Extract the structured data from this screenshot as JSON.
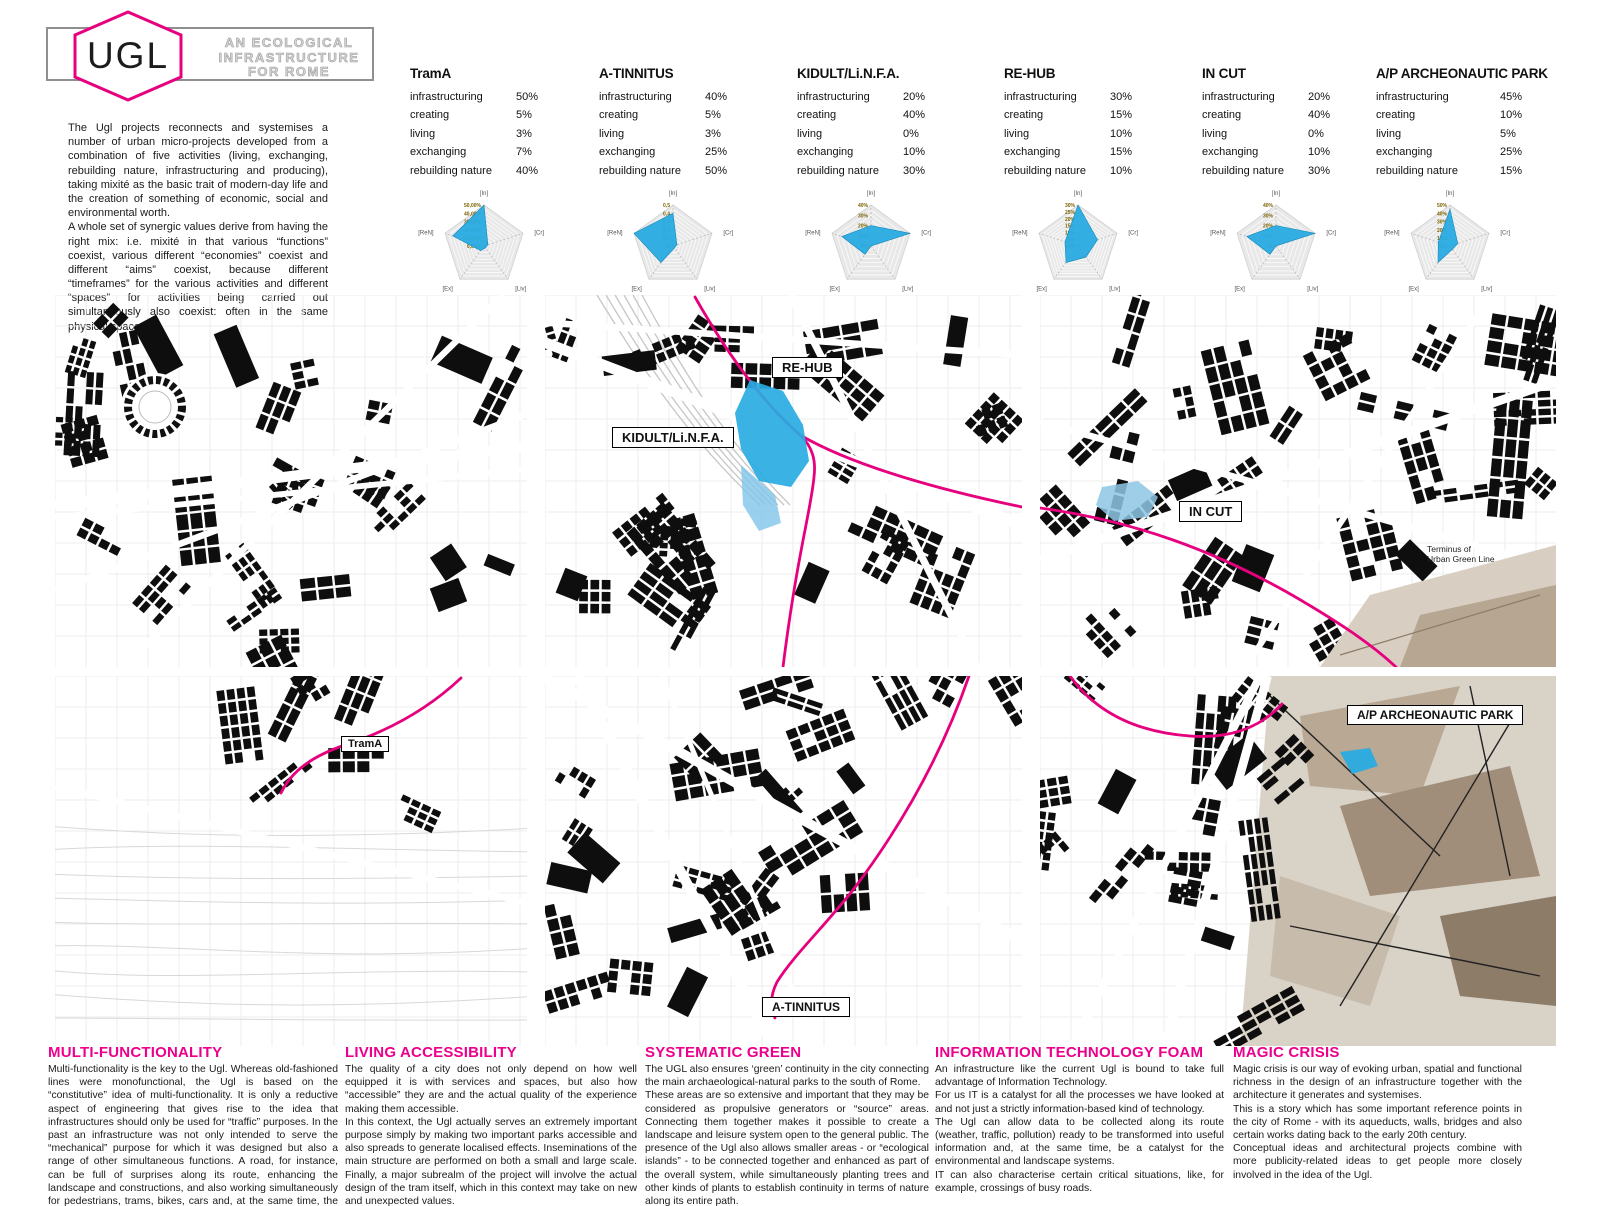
{
  "colors": {
    "magenta": "#e6007e",
    "heading_pink": "#ec008c",
    "radar_blue": "#29abe2",
    "light_blue": "#8ec6e4",
    "tan": "#c9bcab"
  },
  "header": {
    "logo_text": "UGL",
    "subtitle": "AN ECOLOGICAL\nINFRASTRUCTURE\nFOR ROME",
    "intro": "The Ugl projects reconnects and systemises a number of urban micro-projects developed from a combination of five activities (living, exchanging, rebuilding nature, infrastructuring and producing), taking mixité as the basic trait of modern-day life and the creation of something of economic, social and environmental worth.\nA whole set of synergic values derive from having the right mix: i.e. mixité in that various “functions” coexist, various different “economies” coexist and different “aims” coexist, because different “timeframes” for the various activities and different “spaces” for activities being carried out simultaneously also coexist: often in the same physical space."
  },
  "stat_labels": [
    "infrastructuring",
    "creating",
    "living",
    "exchanging",
    "rebuilding nature"
  ],
  "projects": [
    {
      "name": "TramA",
      "stats": [
        "50%",
        "5%",
        "3%",
        "7%",
        "40%"
      ]
    },
    {
      "name": "A-TINNITUS",
      "stats": [
        "40%",
        "5%",
        "3%",
        "25%",
        "50%"
      ]
    },
    {
      "name": "KIDULT/Li.N.F.A.",
      "stats": [
        "20%",
        "40%",
        "0%",
        "10%",
        "30%"
      ]
    },
    {
      "name": "RE-HUB",
      "stats": [
        "30%",
        "15%",
        "10%",
        "15%",
        "10%"
      ]
    },
    {
      "name": "IN CUT",
      "stats": [
        "20%",
        "40%",
        "0%",
        "10%",
        "30%"
      ]
    },
    {
      "name": "A/P ARCHEONAUTIC PARK",
      "stats": [
        "45%",
        "10%",
        "5%",
        "25%",
        "15%"
      ]
    }
  ],
  "chart_data": [
    {
      "type": "radar",
      "title": "TramA",
      "axes": [
        "[In]",
        "[Cr]",
        "[Liv]",
        "[Ex]",
        "[ReN]"
      ],
      "axis_meaning": [
        "infrastructuring",
        "creating",
        "living",
        "exchanging",
        "rebuilding nature"
      ],
      "values": [
        50,
        5,
        3,
        7,
        40
      ],
      "scale_max": 50,
      "tick_labels": [
        "50,00%",
        "40,00%",
        "30,00%",
        "20,00%",
        "10,00%",
        "0,00%"
      ]
    },
    {
      "type": "radar",
      "title": "A-TINNITUS",
      "axes": [
        "[In]",
        "[Cr]",
        "[Liv]",
        "[Ex]",
        "[ReN]"
      ],
      "axis_meaning": [
        "infrastructuring",
        "creating",
        "living",
        "exchanging",
        "rebuilding nature"
      ],
      "values": [
        40,
        5,
        3,
        25,
        50
      ],
      "scale_max": 50,
      "tick_labels": [
        "0,5",
        "0,4",
        "0,3",
        "0,2",
        "0,1",
        "0"
      ]
    },
    {
      "type": "radar",
      "title": "KIDULT/Li.N.F.A.",
      "axes": [
        "[In]",
        "[Cr]",
        "[Liv]",
        "[Ex]",
        "[ReN]"
      ],
      "axis_meaning": [
        "infrastructuring",
        "creating",
        "living",
        "exchanging",
        "rebuilding nature"
      ],
      "values": [
        20,
        40,
        0,
        10,
        30
      ],
      "scale_max": 40,
      "tick_labels": [
        "40%",
        "30%",
        "20%",
        "10%",
        "0%"
      ]
    },
    {
      "type": "radar",
      "title": "RE-HUB",
      "axes": [
        "[In]",
        "[Cr]",
        "[Liv]",
        "[Ex]",
        "[ReN]"
      ],
      "axis_meaning": [
        "infrastructuring",
        "creating",
        "living",
        "exchanging",
        "rebuilding nature"
      ],
      "values": [
        30,
        15,
        10,
        15,
        10
      ],
      "scale_max": 30,
      "tick_labels": [
        "30%",
        "25%",
        "20%",
        "15%",
        "10%",
        "5%",
        "0%"
      ]
    },
    {
      "type": "radar",
      "title": "IN CUT",
      "axes": [
        "[In]",
        "[Cr]",
        "[Liv]",
        "[Ex]",
        "[ReN]"
      ],
      "axis_meaning": [
        "infrastructuring",
        "creating",
        "living",
        "exchanging",
        "rebuilding nature"
      ],
      "values": [
        20,
        40,
        0,
        10,
        30
      ],
      "scale_max": 40,
      "tick_labels": [
        "40%",
        "30%",
        "20%",
        "10%",
        "0%"
      ]
    },
    {
      "type": "radar",
      "title": "A/P ARCHEONAUTIC PARK",
      "axes": [
        "[In]",
        "[Cr]",
        "[Liv]",
        "[Ex]",
        "[ReN]"
      ],
      "axis_meaning": [
        "infrastructuring",
        "creating",
        "living",
        "exchanging",
        "rebuilding nature"
      ],
      "values": [
        45,
        10,
        5,
        25,
        15
      ],
      "scale_max": 50,
      "tick_labels": [
        "50%",
        "40%",
        "30%",
        "20%",
        "10%",
        "0%"
      ]
    }
  ],
  "maps": {
    "labels": {
      "re_hub": "RE-HUB",
      "kidult": "KIDULT/Li.N.F.A.",
      "in_cut": "IN CUT",
      "trama": "TramA",
      "a_tinnitus": "A-TINNITUS",
      "ap_park": "A/P ARCHEONAUTIC PARK",
      "terminus_note": "Terminus of\nUrban Green Line"
    }
  },
  "sections": [
    {
      "heading": "MULTI-FUNCTIONALITY",
      "body": "Multi-functionality is the key to the Ugl. Whereas old-fashioned lines were monofunctional, the Ugl is based on the “constitutive” idea of multi-functionality. It is only a reductive aspect of engineering that gives rise to the idea that infrastructures should only be used for “traffic”  purposes. In the past an infrastructure was not only intended to serve the “mechanical” purpose for which it was designed but also a range of other simultaneous functions. A road, for instance, can be full of surprises along its route, enhancing the landscape and constructions, and also working simultaneously for pedestrians, trams, bikes, cars and, at the same time, the human spirit."
    },
    {
      "heading": "LIVING ACCESSIBILITY",
      "body": "The quality of a city does not only depend on how well equipped it is with services and spaces, but also how “accessible” they are and the actual quality of the experience making them accessible.\nIn this context, the Ugl actually serves an extremely important purpose simply by making two important parks accessible and also spreads to generate localised effects. Inseminations of the main structure are performed on both a small and large scale. Finally, a major subrealm of the project will involve the actual design of the tram itself, which in this context may take on new and unexpected values."
    },
    {
      "heading": "SYSTEMATIC GREEN",
      "body": "The UGL also ensures ‘green’ continuity in the city connecting the main archaeological-natural parks to the south of Rome.\nThese areas are so extensive and important that they may be considered as propulsive generators or “source” areas. Connecting them together makes it possible to create a landscape and leisure system open to the general public. The presence of the Ugl also allows smaller areas - or “ecological islands” - to be connected together and enhanced as part of the overall system, while simultaneously planting trees and other kinds of plants to establish continuity in terms of nature along its entire path."
    },
    {
      "heading": "INFORMATION TECHNOLOGY FOAM",
      "body": "An infrastructure like the current Ugl is bound to take full advantage of Information Technology.\nFor us IT is a catalyst for all the processes we have looked at and not just a strictly information-based kind of technology.\nThe Ugl can allow data to be collected along its route (weather, traffic, pollution) ready to be transformed into useful information and, at the same time, be a catalyst for the environmental and landscape systems.\nIT can also characterise certain critical situations, like, for example, crossings of busy roads."
    },
    {
      "heading": "MAGIC CRISIS",
      "body": "Magic crisis is our way of evoking urban, spatial and functional richness in the design of an infrastructure together with the architecture it generates and systemises.\nThis is a story which has some important reference points in the city of Rome - with its aqueducts, walls, bridges and also certain works dating back to the early 20th century.\nConceptual ideas and architectural projects combine with more publicity-related ideas to get people more closely involved in the idea of the Ugl."
    }
  ]
}
